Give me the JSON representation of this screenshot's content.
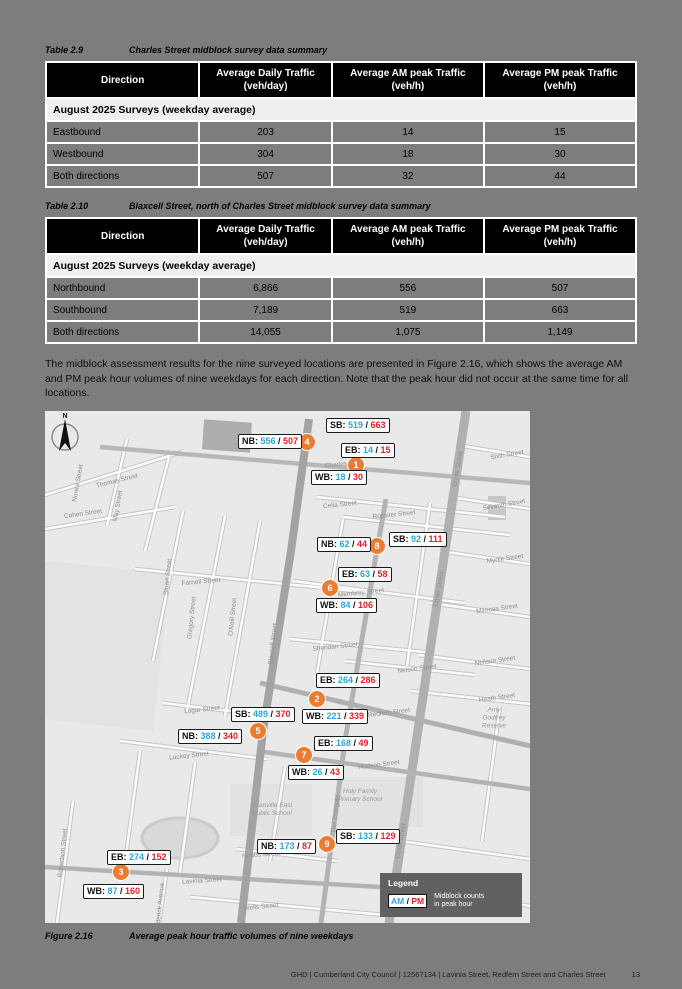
{
  "colors": {
    "am_blue": "#29a8e0",
    "pm_red": "#ee1c25",
    "marker_orange": "#ed7c31",
    "legend_bg": "#616161"
  },
  "tables": [
    {
      "caption_label": "Table 2.9",
      "caption_text": "Charles Street midblock survey data summary",
      "headers": [
        "Direction",
        "Average Daily Traffic\n(veh/day)",
        "Average AM peak Traffic\n(veh/h)",
        "Average PM peak Traffic\n(veh/h)"
      ],
      "subheader": "August 2025 Surveys (weekday average)",
      "rows": [
        [
          "Eastbound",
          "203",
          "14",
          "15"
        ],
        [
          "Westbound",
          "304",
          "18",
          "30"
        ],
        [
          "Both directions",
          "507",
          "32",
          "44"
        ]
      ]
    },
    {
      "caption_label": "Table 2.10",
      "caption_text": "Blaxcell Street, north of Charles Street midblock survey data summary",
      "headers": [
        "Direction",
        "Average Daily Traffic\n(veh/day)",
        "Average AM peak Traffic\n(veh/h)",
        "Average PM peak Traffic\n(veh/h)"
      ],
      "subheader": "August 2025 Surveys (weekday average)",
      "rows": [
        [
          "Northbound",
          "6,866",
          "556",
          "507"
        ],
        [
          "Southbound",
          "7,189",
          "519",
          "663"
        ],
        [
          "Both directions",
          "14,055",
          "1,075",
          "1,149"
        ]
      ]
    }
  ],
  "paragraph": "The midblock assessment results for the nine surveyed locations are presented in Figure 2.16, which shows the average AM and PM peak hour volumes of nine weekdays for each direction. Note that the peak hour did not occur at the same time for all locations.",
  "figure": {
    "caption_label": "Figure 2.16",
    "caption_text": "Average peak hour traffic volumes of nine weekdays",
    "north_label": "N",
    "legend": {
      "title": "Legend",
      "am_label": "AM",
      "pm_label": "PM",
      "separator": " / ",
      "description": "Midblock counts\nin peak hour"
    },
    "count_labels": [
      {
        "prefix": "NB:",
        "am": "556",
        "pm": "507",
        "x": 193,
        "y": 23
      },
      {
        "prefix": "SB:",
        "am": "519",
        "pm": "663",
        "x": 281,
        "y": 7
      },
      {
        "prefix": "EB:",
        "am": "14",
        "pm": "15",
        "x": 296,
        "y": 32
      },
      {
        "prefix": "WB:",
        "am": "18",
        "pm": "30",
        "x": 266,
        "y": 59
      },
      {
        "prefix": "NB:",
        "am": "62",
        "pm": "44",
        "x": 272,
        "y": 126
      },
      {
        "prefix": "SB:",
        "am": "92",
        "pm": "111",
        "x": 344,
        "y": 121
      },
      {
        "prefix": "EB:",
        "am": "63",
        "pm": "58",
        "x": 293,
        "y": 156
      },
      {
        "prefix": "WB:",
        "am": "84",
        "pm": "106",
        "x": 271,
        "y": 187
      },
      {
        "prefix": "EB:",
        "am": "264",
        "pm": "286",
        "x": 271,
        "y": 262
      },
      {
        "prefix": "WB:",
        "am": "221",
        "pm": "339",
        "x": 257,
        "y": 298
      },
      {
        "prefix": "SB:",
        "am": "489",
        "pm": "370",
        "x": 186,
        "y": 296
      },
      {
        "prefix": "NB:",
        "am": "388",
        "pm": "340",
        "x": 133,
        "y": 318
      },
      {
        "prefix": "EB:",
        "am": "168",
        "pm": "49",
        "x": 269,
        "y": 325
      },
      {
        "prefix": "WB:",
        "am": "26",
        "pm": "43",
        "x": 243,
        "y": 354
      },
      {
        "prefix": "EB:",
        "am": "274",
        "pm": "152",
        "x": 62,
        "y": 439
      },
      {
        "prefix": "WB:",
        "am": "87",
        "pm": "160",
        "x": 38,
        "y": 473
      },
      {
        "prefix": "SB:",
        "am": "133",
        "pm": "129",
        "x": 291,
        "y": 418
      },
      {
        "prefix": "NB:",
        "am": "173",
        "pm": "87",
        "x": 212,
        "y": 428
      }
    ],
    "markers": [
      {
        "n": "4",
        "x": 262,
        "y": 31
      },
      {
        "n": "1",
        "x": 311,
        "y": 54
      },
      {
        "n": "8",
        "x": 332,
        "y": 135
      },
      {
        "n": "6",
        "x": 285,
        "y": 177
      },
      {
        "n": "2",
        "x": 272,
        "y": 288
      },
      {
        "n": "5",
        "x": 213,
        "y": 320
      },
      {
        "n": "7",
        "x": 259,
        "y": 344
      },
      {
        "n": "3",
        "x": 76,
        "y": 461
      },
      {
        "n": "9",
        "x": 282,
        "y": 433
      }
    ],
    "street_labels": [
      {
        "text": "Thomas Street",
        "x": 72,
        "y": 70,
        "rot": -14
      },
      {
        "text": "Nowra Street",
        "x": 33,
        "y": 72,
        "rot": -80
      },
      {
        "text": "May Street",
        "x": 73,
        "y": 95,
        "rot": -80
      },
      {
        "text": "Cohen Street",
        "x": 38,
        "y": 103,
        "rot": -8
      },
      {
        "text": "Farnell Street",
        "x": 156,
        "y": 171,
        "rot": -5
      },
      {
        "text": "Stuart Street",
        "x": 123,
        "y": 166,
        "rot": -84
      },
      {
        "text": "Gregory Street",
        "x": 147,
        "y": 207,
        "rot": -84
      },
      {
        "text": "O'Neill Street",
        "x": 188,
        "y": 206,
        "rot": -84
      },
      {
        "text": "Blaxcell Street",
        "x": 228,
        "y": 233,
        "rot": -84
      },
      {
        "text": "Lugar Street",
        "x": 157,
        "y": 299,
        "rot": -6
      },
      {
        "text": "Lackey Street",
        "x": 144,
        "y": 345,
        "rot": -6
      },
      {
        "text": "Robertson Street",
        "x": 18,
        "y": 442,
        "rot": -84
      },
      {
        "text": "Frederick Avenue",
        "x": 115,
        "y": 497,
        "rot": -84
      },
      {
        "text": "Lavinia Street",
        "x": 157,
        "y": 470,
        "rot": -4
      },
      {
        "text": "Wells Street",
        "x": 216,
        "y": 496,
        "rot": -6
      },
      {
        "text": "Nobbs Street",
        "x": 216,
        "y": 444,
        "rot": -5
      },
      {
        "text": "The Trongate",
        "x": 291,
        "y": 403,
        "rot": -84
      },
      {
        "text": "Charles",
        "x": 291,
        "y": 54,
        "rot": -6
      },
      {
        "text": "Celia Street",
        "x": 295,
        "y": 94,
        "rot": -6
      },
      {
        "text": "Rossiter Street",
        "x": 349,
        "y": 104,
        "rot": -6
      },
      {
        "text": "Membrey Street",
        "x": 316,
        "y": 182,
        "rot": -6
      },
      {
        "text": "Sheridan Street",
        "x": 290,
        "y": 236,
        "rot": -6
      },
      {
        "text": "Nelson Street",
        "x": 372,
        "y": 258,
        "rot": -7
      },
      {
        "text": "Redfern Street",
        "x": 344,
        "y": 302,
        "rot": -7
      },
      {
        "text": "Hudson Street",
        "x": 334,
        "y": 354,
        "rot": -7
      },
      {
        "text": "Sixth Street",
        "x": 462,
        "y": 44,
        "rot": -10
      },
      {
        "text": "Seventh Street",
        "x": 459,
        "y": 94,
        "rot": -10
      },
      {
        "text": "Myrtle Street",
        "x": 460,
        "y": 148,
        "rot": -8
      },
      {
        "text": "Mimosa Street",
        "x": 452,
        "y": 198,
        "rot": -8
      },
      {
        "text": "Neilson Street",
        "x": 450,
        "y": 250,
        "rot": -8
      },
      {
        "text": "Heath Street",
        "x": 452,
        "y": 287,
        "rot": -8
      },
      {
        "text": "Clyde Street",
        "x": 413,
        "y": 58,
        "rot": -80
      },
      {
        "text": "Clyde Street",
        "x": 394,
        "y": 178,
        "rot": -80
      },
      {
        "text": "Clyde Street",
        "x": 356,
        "y": 430,
        "rot": -80
      }
    ],
    "places": [
      {
        "text": "Granville East\nPublic School",
        "x": 227,
        "y": 399
      },
      {
        "text": "Holy Family\nPrimary School",
        "x": 315,
        "y": 385
      },
      {
        "text": "Amy Godfrey\nReserve",
        "x": 449,
        "y": 307
      }
    ]
  },
  "footer": {
    "text": "GHD | Cumberland City Council | 12567134 | Lavinia Street, Redfern Street and Charles Street",
    "page_number": "13"
  }
}
